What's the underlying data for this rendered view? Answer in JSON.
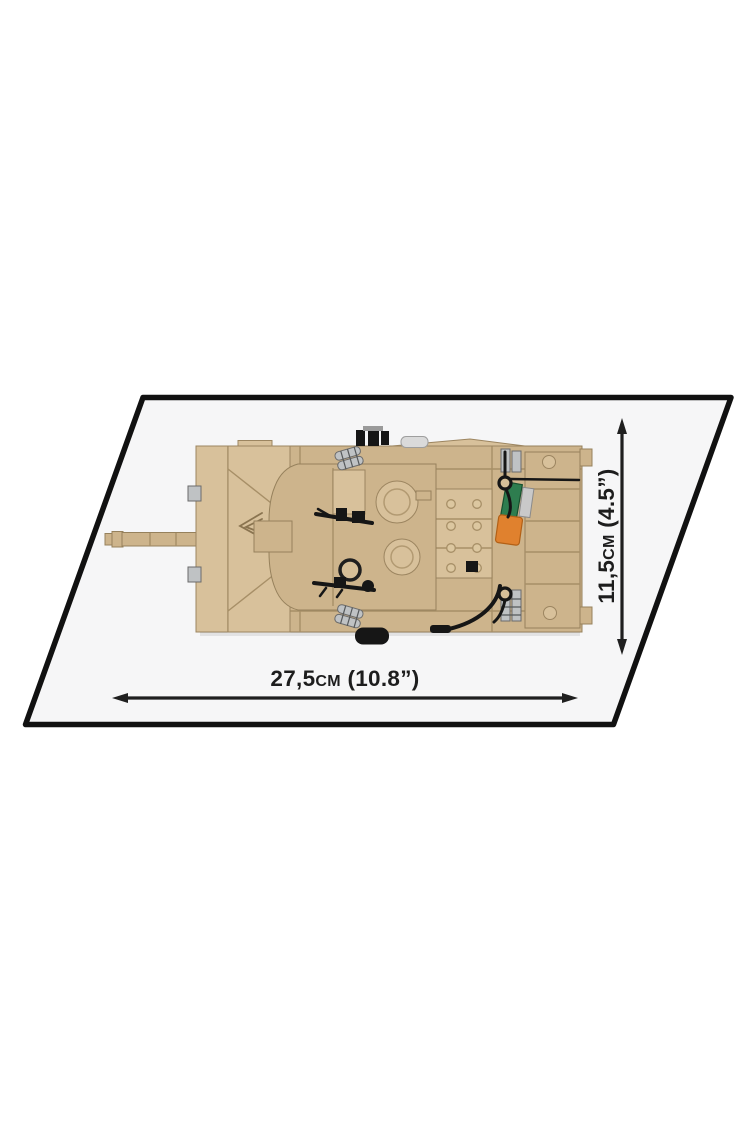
{
  "page": {
    "background": "#ffffff"
  },
  "figure": {
    "title": "Product dimensions diagram",
    "subject": "Brick-built tank model, top view, on a tilted white display plate",
    "width_label": "27,5cm (10.8”)",
    "height_label": "11,5cm (4.5”)",
    "colors": {
      "plate_fill": "#f6f6f7",
      "plate_border": "#111111",
      "arrow": "#1f1f1f",
      "label_text": "#1d1d1d",
      "tank_tan": "#cdb48c",
      "tank_tan_light": "#d8c19b",
      "tank_tan_dark": "#bea97e",
      "accent_green": "#2e7d4f",
      "accent_orange": "#e0812e",
      "detail_gray": "#bfc2c4",
      "detail_black": "#161616"
    }
  }
}
